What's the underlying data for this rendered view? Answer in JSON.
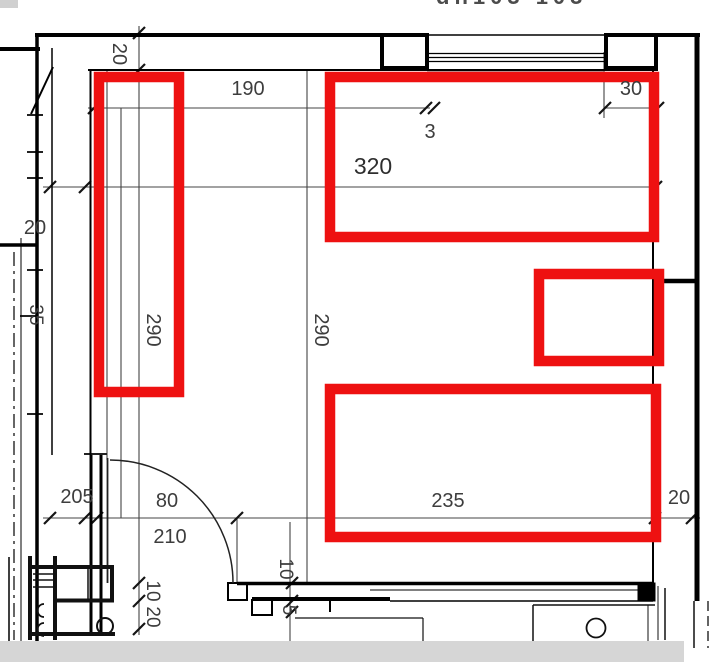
{
  "drawing": {
    "clipped_title": "dn103 103",
    "labels": {
      "len_190": "190",
      "len_30": "30",
      "len_3": "3",
      "len_320": "320",
      "wall_20_top": "20",
      "wall_20_left": "20",
      "len_290_left": "290",
      "len_290_mid": "290",
      "len_205": "205",
      "door_width_80": "80",
      "door_height_210": "210",
      "len_235": "235",
      "wall_20_right": "20",
      "len_10_left": "10",
      "len_20_bottom": "20",
      "len_10_mid": "10",
      "len_5_mid": "5",
      "len_35_edge": "35"
    },
    "colors": {
      "highlight_red": "#ee1111",
      "line_black": "#000000",
      "dim_gray": "#3d3d3d",
      "footer_gray": "#d6d6d6",
      "corner_gray": "#d0d0d0"
    },
    "highlights": [
      {
        "id": "tall-left"
      },
      {
        "id": "top-wide"
      },
      {
        "id": "small-right"
      },
      {
        "id": "bottom-wide"
      }
    ]
  }
}
